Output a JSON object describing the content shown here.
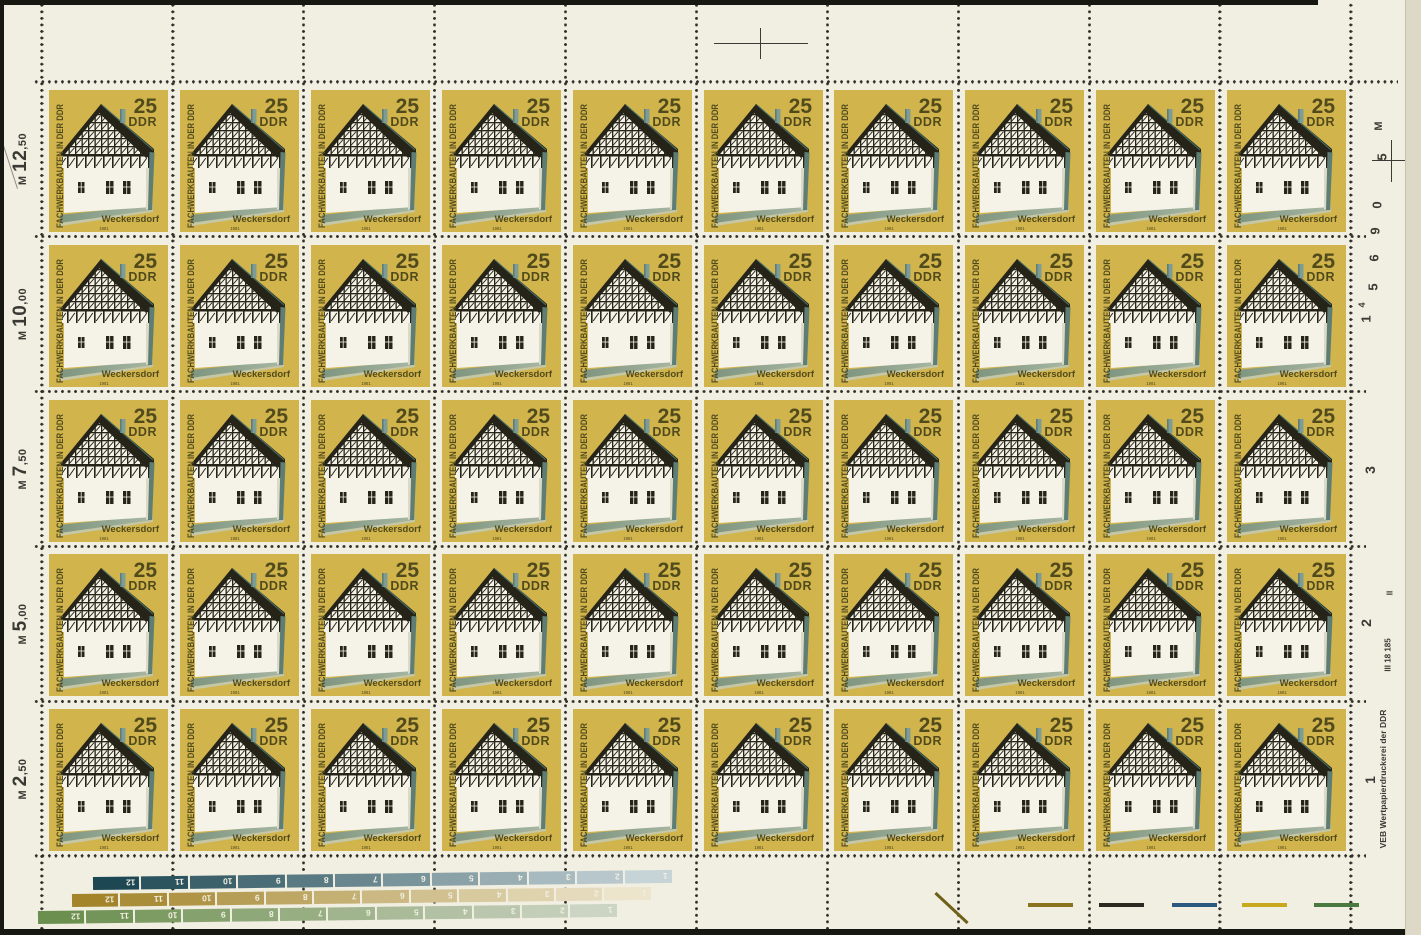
{
  "sheet": {
    "description": "Full sheet scan of 50 DDR stamps, 10 columns x 5 rows",
    "stamp": {
      "value": "25",
      "currency": "DDR",
      "side_text": "FACHWERKBAUTEN IN DER DDR",
      "place": "Weckersdorf",
      "year": "1981",
      "colors": {
        "background": "#d2b44c",
        "text": "#514b1c",
        "dark": "#262418",
        "white": "#f5f3e8",
        "teal_light": "#7d9c95",
        "teal_dark": "#5d7d75",
        "ridge": "#46716a",
        "ground_dark": "#7e957f",
        "ground_light": "#a8b7a4",
        "side_shade": "#dcd9c6"
      }
    },
    "left_margin": {
      "labels": [
        "M 12,50",
        "M 10,00",
        "M 7,50",
        "M 5,00",
        "M 2,50"
      ]
    },
    "right_margin": {
      "printer_text": "VEB Wertpapierdruckerei der DDR",
      "marks": [
        {
          "text": "M",
          "x": 1379,
          "y": 126,
          "size": 11
        },
        {
          "text": "5",
          "x": 1382,
          "y": 157,
          "size": 13
        },
        {
          "text": "0",
          "x": 1377,
          "y": 205,
          "size": 13
        },
        {
          "text": "9",
          "x": 1375,
          "y": 231,
          "size": 13
        },
        {
          "text": "6",
          "x": 1374,
          "y": 258,
          "size": 13
        },
        {
          "text": "5",
          "x": 1373,
          "y": 287,
          "size": 13
        },
        {
          "text": "4",
          "x": 1362,
          "y": 305,
          "size": 9
        },
        {
          "text": "1",
          "x": 1366,
          "y": 319,
          "size": 13
        },
        {
          "text": "3",
          "x": 1370,
          "y": 470,
          "size": 14
        },
        {
          "text": "II",
          "x": 1390,
          "y": 593,
          "size": 8
        },
        {
          "text": "2",
          "x": 1366,
          "y": 623,
          "size": 14
        },
        {
          "text": "III 18 185",
          "x": 1388,
          "y": 655,
          "size": 8
        },
        {
          "text": "1",
          "x": 1370,
          "y": 780,
          "size": 14
        },
        {
          "text": "VEB Wertpapierdruckerei der DDR",
          "x": 1383,
          "y": 779,
          "size": 8.5
        }
      ]
    },
    "bottom_bars": {
      "segment_numbers": [
        12,
        11,
        10,
        9,
        8,
        7,
        6,
        5,
        4,
        3,
        2,
        1
      ],
      "bars": [
        {
          "name": "petrol",
          "start_color": "#1d4752",
          "end_color": "#c6d4d8",
          "x": 93,
          "y": 877
        },
        {
          "name": "ochre",
          "start_color": "#a3842a",
          "end_color": "#ece4cb",
          "x": 72,
          "y": 894
        },
        {
          "name": "green",
          "start_color": "#6b8f4e",
          "end_color": "#ccd4c3",
          "x": 38,
          "y": 911
        }
      ]
    },
    "bottom_dashes": [
      {
        "color": "#8a7420",
        "x": 1028
      },
      {
        "color": "#2a2a22",
        "x": 1099
      },
      {
        "color": "#2a5a80",
        "x": 1172
      },
      {
        "color": "#c8a81e",
        "x": 1242
      },
      {
        "color": "#4a7a40",
        "x": 1314
      }
    ],
    "perforation_dot_color": "#2f2d27",
    "paper_color": "#f1eee2"
  }
}
